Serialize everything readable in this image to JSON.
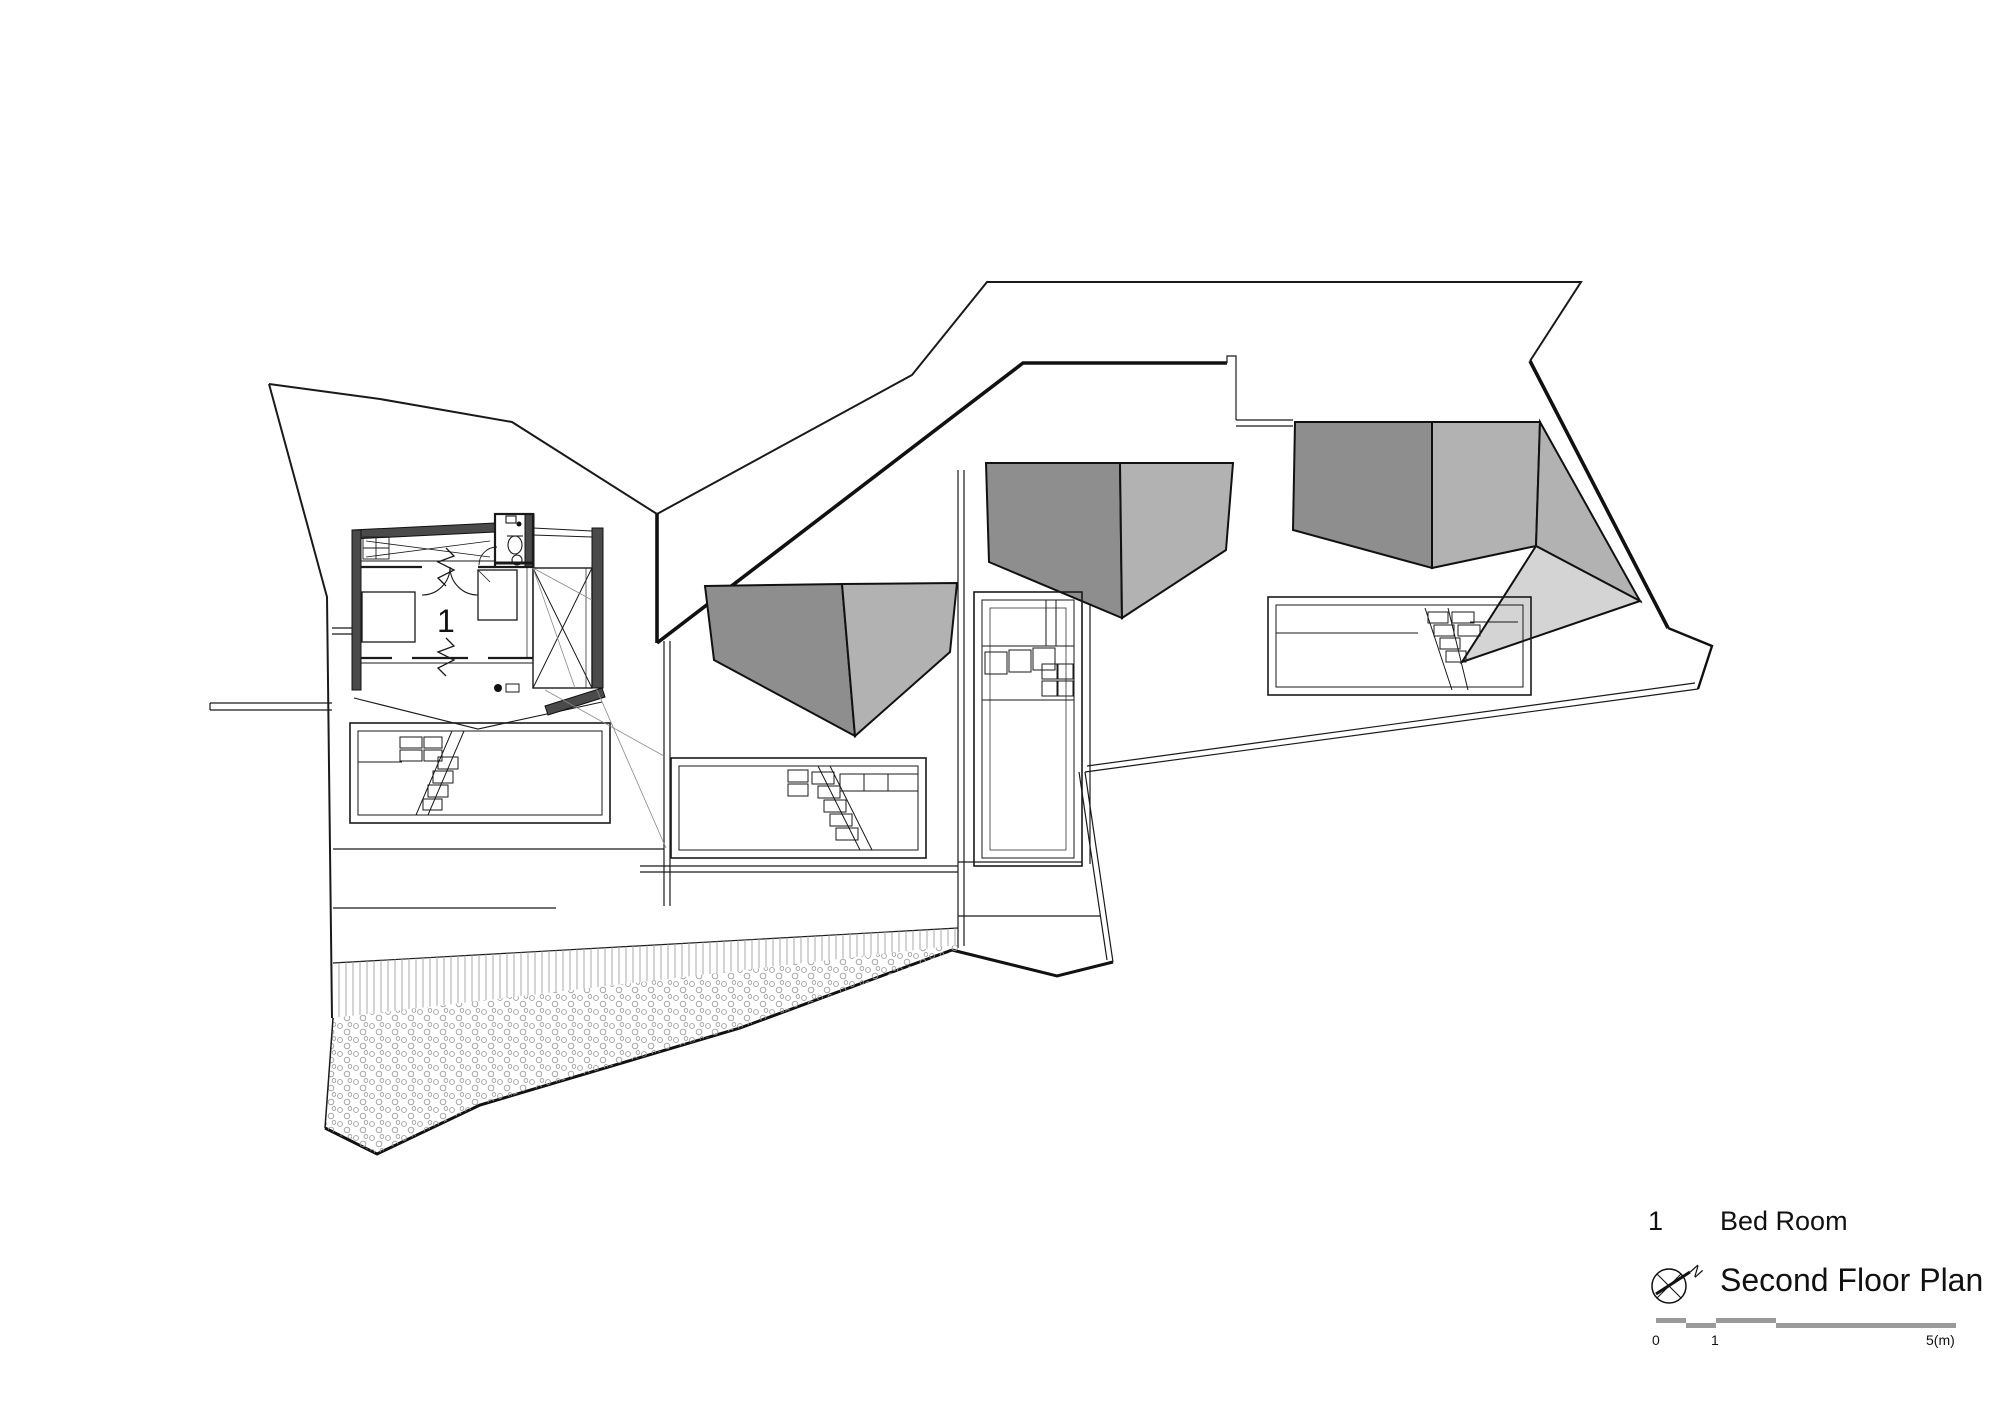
{
  "drawing": {
    "room_label": "1",
    "colors": {
      "line": "#1a1a1a",
      "wall": "#4a4a4a",
      "roof_dark": "#8e8e8e",
      "roof_medium": "#b2b2b2",
      "roof_light": "#d4d4d4",
      "scale_bar": "#9a9a9a"
    }
  },
  "legend": {
    "items": [
      {
        "number": "1",
        "label": "Bed Room"
      }
    ]
  },
  "title": "Second Floor Plan",
  "compass": {
    "north": "N"
  },
  "scale_bar": {
    "labels": {
      "start": "0",
      "mid": "1",
      "end": "5(m)"
    }
  }
}
